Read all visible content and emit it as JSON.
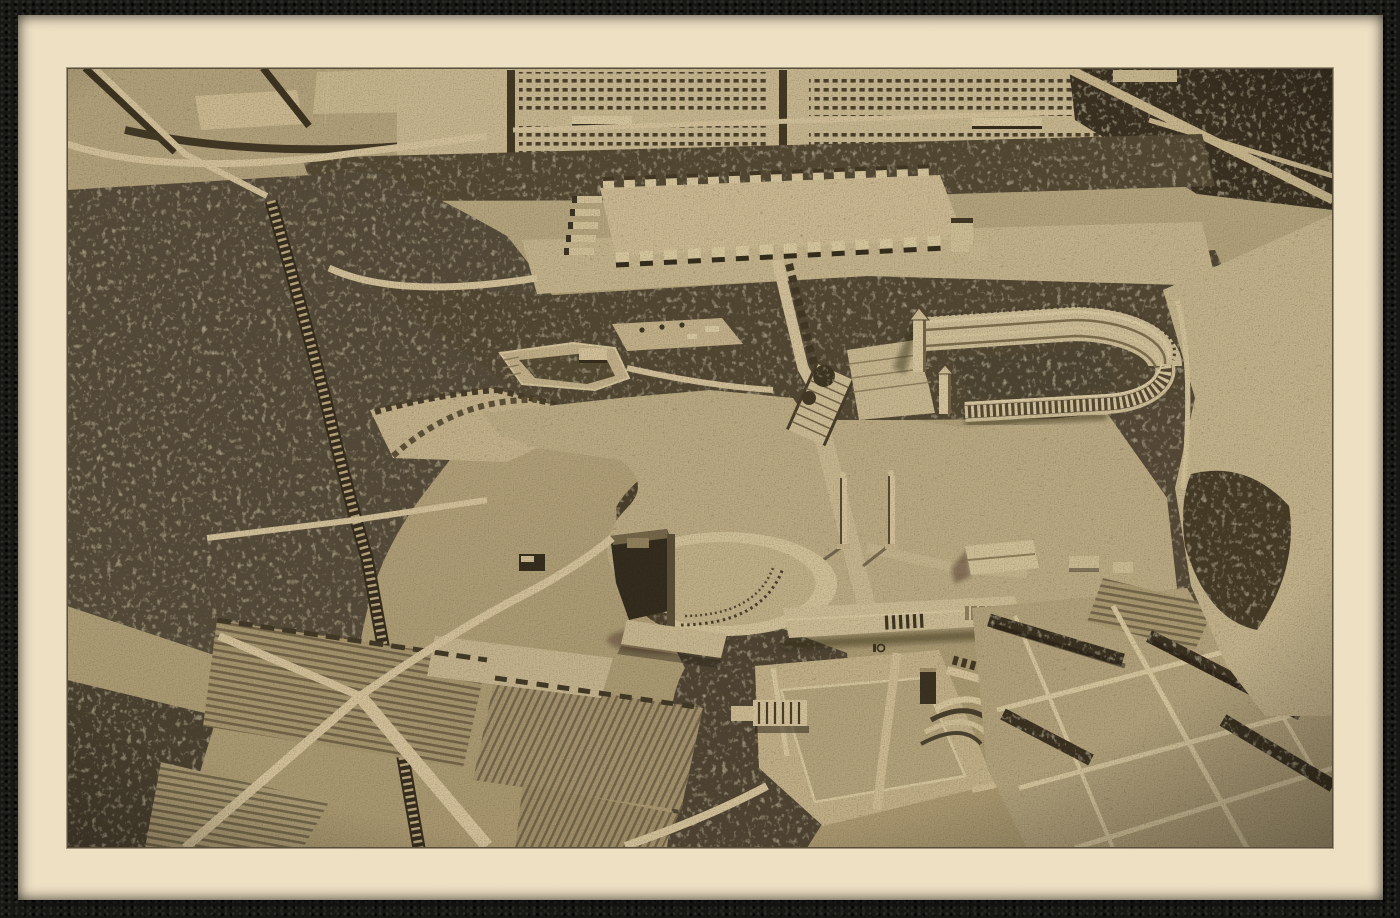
{
  "document": {
    "kind": "Vintage sepia postcard photograph",
    "title": "Aerial view of an architectural scale model of monumental parade grounds",
    "description": "A cream-bordered postcard print of a bird's-eye photograph showing a plaster scale model: a gridded camp at top, a rectangular parade field ringed by towers, a horseshoe-shaped stadium, a round-fronted hall, twin obelisks on a broad plaza, a memorial field with a curved amphitheater, forests crossed by roads and a railway, and a patchwork of farm fields.",
    "visible_text": "none"
  },
  "palette": {
    "frame_black": "#171714",
    "card_cream": "#eee0c3",
    "photo_base": "#b0a17c",
    "ground_light": "#cdbd96",
    "road_light": "#d5c59e",
    "highlight": "#e2d4ae",
    "forest_dark": "#4a4030",
    "forest_deep": "#352c1d",
    "shadow": "#241d10"
  },
  "scene": {
    "landmarks": {
      "photo": {
        "label": "Sepia aerial photograph of the model"
      },
      "card": {
        "label": "Cream postcard mount"
      },
      "frame": {
        "label": "Black pebbled album backing"
      },
      "tent_camp": {
        "label": "Gridded encampment of small huts (top)"
      },
      "topleft": {
        "label": "Fields and lanes (top left)"
      },
      "topright": {
        "label": "Dark fields with crossing roads (top right)"
      },
      "forest": {
        "label": "Forest masses with cut roads"
      },
      "parade_field": {
        "label": "Rectangular parade field ringed by towers"
      },
      "railway": {
        "label": "Railway line with cross ties"
      },
      "roads": {
        "label": "Light roads through the grounds"
      },
      "small_arena": {
        "label": "Small arena terrace among trees"
      },
      "allee_field": {
        "label": "Tree-lined rectangular field"
      },
      "plaza": {
        "label": "Great open plaza"
      },
      "stairs": {
        "label": "Broad stair axis up to the parade field"
      },
      "stadium": {
        "label": "Horseshoe stadium with colonnade and towers"
      },
      "obelisks": {
        "label": "Twin obelisk pillars"
      },
      "round_hall": {
        "label": "Round-fronted congress hall with dark annex"
      },
      "long_hall": {
        "label": "Long colonnaded grandstand building"
      },
      "memorial": {
        "label": "Memorial field with curved amphitheater tiers"
      },
      "gardens": {
        "label": "Striped garden plots and lanes (bottom left)"
      },
      "patchwork": {
        "label": "Patchwork farm fields and hedgerows (bottom right)"
      },
      "clearing": {
        "label": "Open clearing along right edge"
      }
    }
  }
}
